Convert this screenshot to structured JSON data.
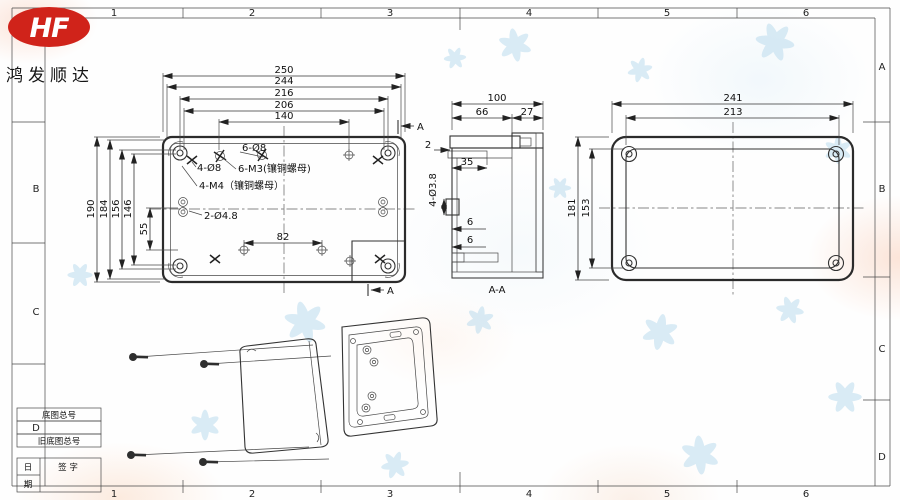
{
  "company": {
    "logo_text": "HF",
    "name": "鸿发顺达"
  },
  "border": {
    "top_numbers": [
      "1",
      "2",
      "3",
      "4",
      "5",
      "6"
    ],
    "bottom_numbers": [
      "1",
      "2",
      "3",
      "4",
      "5",
      "6"
    ],
    "right_letters": [
      "A",
      "B",
      "C",
      "D"
    ],
    "left_letters": [
      "B",
      "C"
    ],
    "zone_letter_d": "D"
  },
  "title_block": {
    "base_no": "底图总号",
    "old_base_no": "旧底图总号",
    "date_top": "日",
    "date_bottom": "期",
    "signature": "签  字"
  },
  "top_view": {
    "dim_250": "250",
    "dim_244": "244",
    "dim_216": "216",
    "dim_206": "206",
    "dim_140": "140",
    "dim_190": "190",
    "dim_184": "184",
    "dim_156": "156",
    "dim_146": "146",
    "dim_55": "55",
    "dim_82": "82",
    "callout_6_d8": "6-Ø8",
    "callout_4_d8": "4-Ø8",
    "callout_6_m3": "6-M3(镶铜螺母)",
    "callout_4_m4": "4-M4（镶铜螺母）",
    "callout_2_d48": "2-Ø4.8",
    "section_top": "A",
    "section_bottom": "A"
  },
  "section_view": {
    "dim_100": "100",
    "dim_66": "66",
    "dim_27": "27",
    "dim_2": "2",
    "dim_35": "35",
    "dim_4_d38": "4-Ø3.8",
    "dim_6_upper": "6",
    "dim_6_lower": "6",
    "label": "A-A"
  },
  "end_view": {
    "dim_241": "241",
    "dim_213": "213",
    "dim_181": "181",
    "dim_153": "153"
  }
}
